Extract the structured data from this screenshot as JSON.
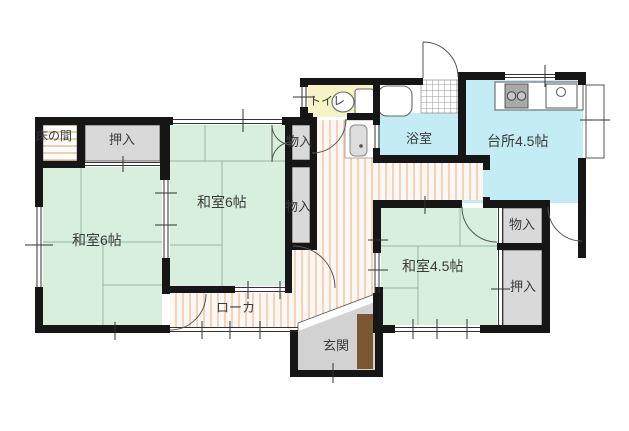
{
  "plan": {
    "rooms": {
      "tokonoma": {
        "label": "床の間"
      },
      "oshiire_nw": {
        "label": "押入"
      },
      "washitsu_west": {
        "label": "和室6帖"
      },
      "washitsu_mid": {
        "label": "和室6帖"
      },
      "storage_mid_upper": {
        "label": "物入"
      },
      "storage_mid_lower": {
        "label": "物入"
      },
      "toilet": {
        "label": "トイレ"
      },
      "bath": {
        "label": "浴室"
      },
      "kitchen": {
        "label": "台所4.5帖"
      },
      "washitsu_east": {
        "label": "和室4.5帖"
      },
      "storage_east": {
        "label": "物入"
      },
      "oshiire_east": {
        "label": "押入"
      },
      "corridor": {
        "label": "ローカ"
      },
      "entrance": {
        "label": "玄関"
      }
    },
    "colors": {
      "wall": "#161616",
      "tatami": "#d7efdc",
      "tatamiline": "#97b7a5",
      "water": "#c3ecf4",
      "toilet": "#f6f3c5",
      "closet": "#d9d9d9",
      "genkan": "#d2d2d2",
      "door": "#7a5631",
      "stripe": "#f3d3bb",
      "stripebg": "#fdf8f3",
      "wood": "#e8bd92"
    }
  }
}
